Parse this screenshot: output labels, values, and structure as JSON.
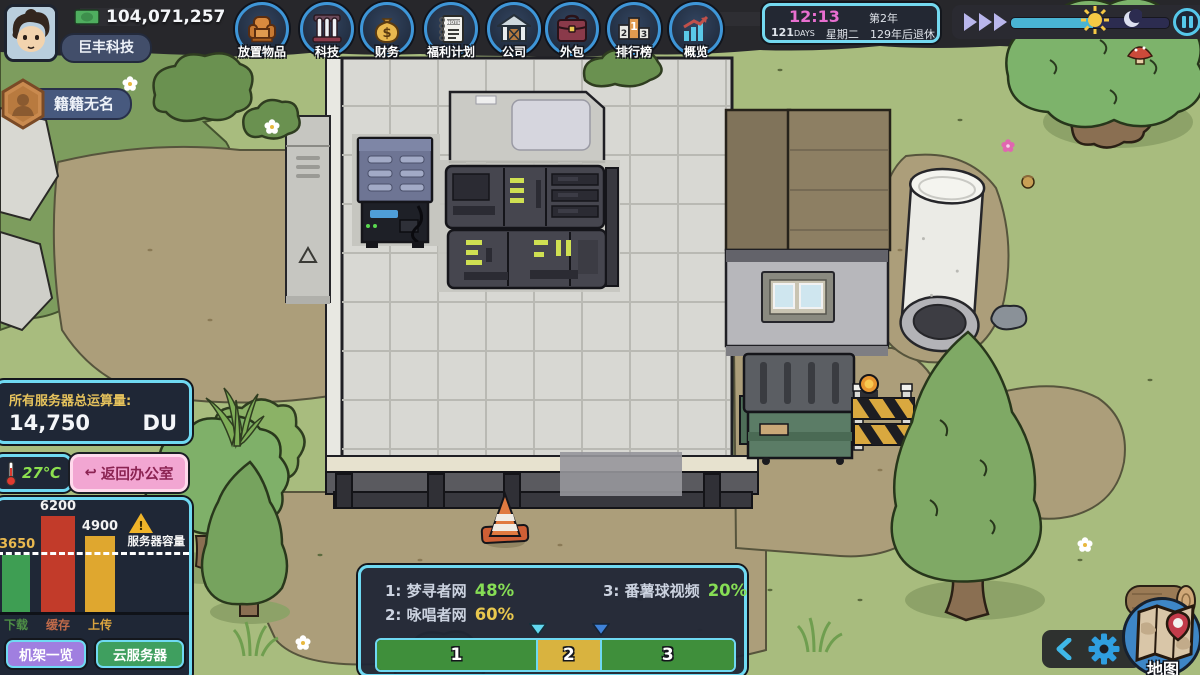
{
  "topbar": {
    "money": "104,071,257",
    "company": "巨丰科技",
    "rank": "籍籍无名",
    "icons": [
      {
        "label": "放置物品",
        "icon": "armchair-icon"
      },
      {
        "label": "科技",
        "icon": "testtubes-icon"
      },
      {
        "label": "财务",
        "icon": "moneybag-icon",
        "glyph": "$"
      },
      {
        "label": "福利计划",
        "icon": "note-icon",
        "note_text": "NOTE"
      },
      {
        "label": "公司",
        "icon": "house-icon"
      },
      {
        "label": "外包",
        "icon": "briefcase-icon"
      },
      {
        "label": "排行榜",
        "icon": "podium-icon",
        "podium": [
          "2",
          "1",
          "3"
        ]
      },
      {
        "label": "概览",
        "icon": "chart-icon"
      }
    ]
  },
  "clock": {
    "time": "12:13",
    "year": "第2年",
    "days_value": "121",
    "days_unit": "DAYS",
    "weekday": "星期二",
    "retirement": "129年后退休"
  },
  "stats": {
    "title": "所有服务器总运算量:",
    "value": "14,750",
    "unit": "DU"
  },
  "temperature": "27℃",
  "back_button": "返回办公室",
  "chart_data": {
    "type": "bar",
    "title": "",
    "categories": [
      "下载",
      "缓存",
      "上传"
    ],
    "values": [
      3650,
      6200,
      4900
    ],
    "value_labels": [
      "3650",
      "6200",
      "4900"
    ],
    "bar_colors": [
      "#3e9e53",
      "#c23b2a",
      "#dfa72f"
    ],
    "label_colors": [
      "#4e8f46",
      "#c06a4a",
      "#d8a23f"
    ],
    "capacity_line": {
      "value": 3650,
      "label": "服务器容量"
    },
    "ylim": [
      0,
      6200
    ],
    "warning_icon": "!"
  },
  "panel_buttons": {
    "rack": "机架一览",
    "cloud": "云服务器"
  },
  "traffic_panel": {
    "sites": [
      {
        "prefix": "1:",
        "name": "梦寻者网",
        "pct": "48%",
        "pct_color": "#86dd55"
      },
      {
        "prefix": "2:",
        "name": "咏唱者网",
        "pct": "60%",
        "pct_color": "#e9c84e"
      },
      {
        "prefix": "3:",
        "name": "番薯球视频",
        "pct": "20%",
        "pct_color": "#86dd55"
      }
    ],
    "tabs": [
      "1",
      "2",
      "3"
    ]
  },
  "minimap": {
    "label": "地图"
  }
}
